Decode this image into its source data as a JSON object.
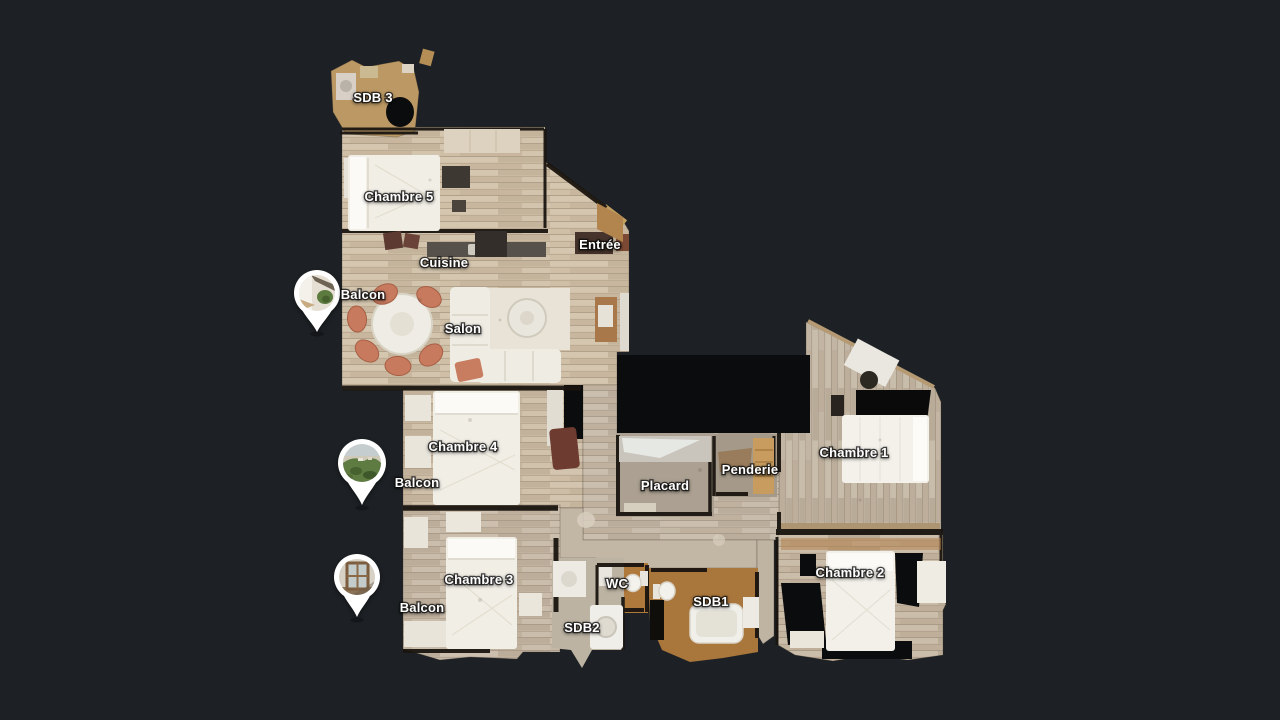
{
  "app": {
    "name": "3d-floorplan-viewer",
    "view": "floorplan-top-down"
  },
  "floorplan": {
    "rooms": [
      {
        "id": "sdb-3",
        "label": "SDB 3"
      },
      {
        "id": "chambre-5",
        "label": "Chambre 5"
      },
      {
        "id": "entree",
        "label": "Entrée"
      },
      {
        "id": "cuisine",
        "label": "Cuisine"
      },
      {
        "id": "salon",
        "label": "Salon"
      },
      {
        "id": "chambre-4",
        "label": "Chambre 4"
      },
      {
        "id": "placard",
        "label": "Placard"
      },
      {
        "id": "penderie",
        "label": "Penderie"
      },
      {
        "id": "chambre-1",
        "label": "Chambre 1"
      },
      {
        "id": "chambre-3",
        "label": "Chambre 3"
      },
      {
        "id": "wc",
        "label": "WC"
      },
      {
        "id": "sdb1",
        "label": "SDB1"
      },
      {
        "id": "sdb2",
        "label": "SDB2"
      },
      {
        "id": "chambre-2",
        "label": "Chambre 2"
      }
    ],
    "markers": [
      {
        "id": "balcon-salon",
        "label": "Balcon",
        "photo": "balcony-interior-view"
      },
      {
        "id": "balcon-chambre-4",
        "label": "Balcon",
        "photo": "balcony-aerial-landscape-view"
      },
      {
        "id": "balcon-chambre-3",
        "label": "Balcon",
        "photo": "balcony-window-view"
      }
    ]
  },
  "colors": {
    "background": "#1d2125",
    "label_text": "#ffffff",
    "marker_border": "#ffffff",
    "floor_wood": "#cfbfa7",
    "floor_tile": "#ad7a3c",
    "unscanned_hole": "#0b0c0d"
  }
}
